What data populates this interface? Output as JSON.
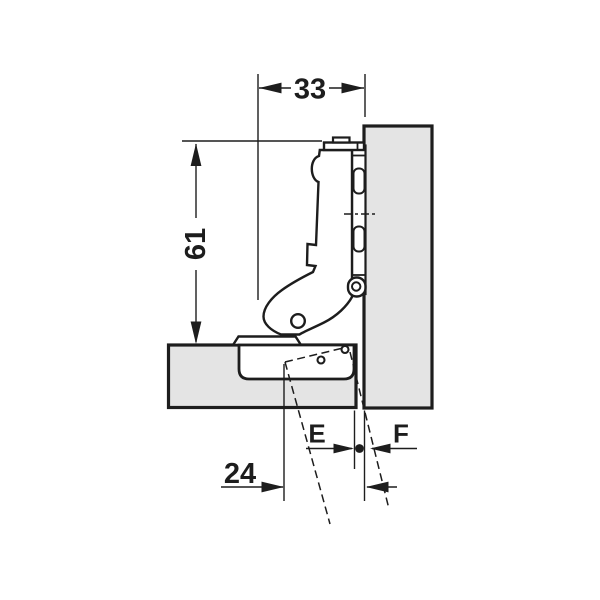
{
  "drawing": {
    "dimensions": {
      "top_width": "33",
      "left_height": "61",
      "bottom_offset": "24",
      "gap_left": "E",
      "gap_right": "F"
    },
    "colors": {
      "line": "#1d1d1d",
      "panel_fill": "#e4e4e4",
      "background": "#ffffff"
    }
  }
}
